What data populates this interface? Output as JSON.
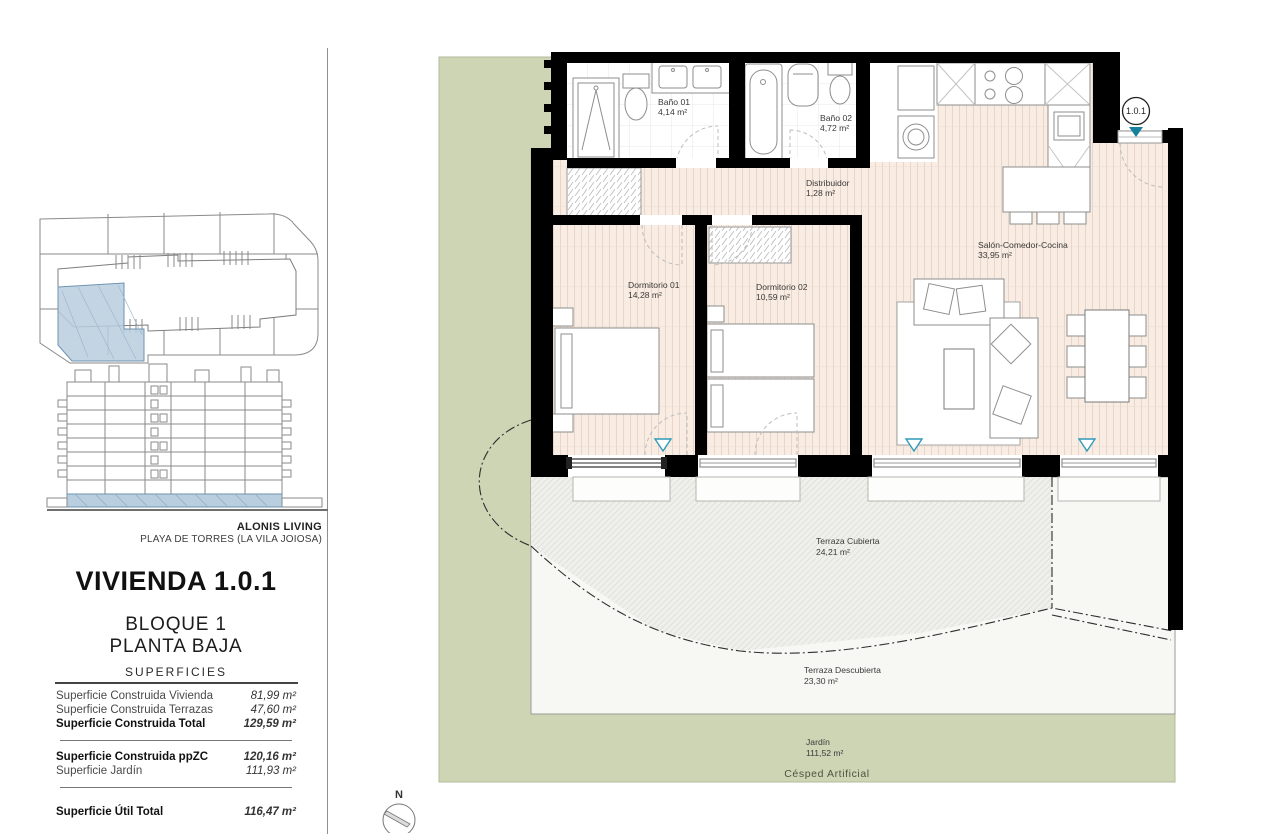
{
  "sidebar": {
    "brand": "ALONIS LIVING",
    "brand_sub": "PLAYA DE TORRES (LA VILA JOIOSA)",
    "title": "VIVIENDA 1.0.1",
    "block": "BLOQUE 1",
    "floor": "PLANTA BAJA",
    "table_title": "SUPERFICIES",
    "rows": [
      {
        "label": "Superficie Construida Vivienda",
        "value": "81,99 m²"
      },
      {
        "label": "Superficie Construida Terrazas",
        "value": "47,60 m²"
      },
      {
        "label": "Superficie Construida Total",
        "value": "129,59 m²"
      },
      {
        "label": "Superficie Construida ppZC",
        "value": "120,16 m²"
      },
      {
        "label": "Superficie Jardín",
        "value": "111,93 m²"
      },
      {
        "label": "Superficie Útil Total",
        "value": "116,47 m²"
      }
    ]
  },
  "plan": {
    "unit_tag": "1.0.1",
    "north_label": "N",
    "garden_label": "Césped Artificial",
    "rooms": [
      {
        "name": "Baño 01",
        "area": "4,14 m²"
      },
      {
        "name": "Baño 02",
        "area": "4,72 m²"
      },
      {
        "name": "Distribuidor",
        "area": "1,28 m²"
      },
      {
        "name": "Salón-Comedor-Cocina",
        "area": "33,95 m²"
      },
      {
        "name": "Dormitorio 01",
        "area": "14,28 m²"
      },
      {
        "name": "Dormitorio 02",
        "area": "10,59 m²"
      },
      {
        "name": "Terraza Cubierta",
        "area": "24,21 m²"
      },
      {
        "name": "Terraza Descubierta",
        "area": "23,30 m²"
      },
      {
        "name": "Jardín",
        "area": "111,52 m²"
      }
    ]
  },
  "colors": {
    "garden_green": "#cdd5b5",
    "wood_floor": "#f8ece3",
    "terrace_grey": "#f2f2ee",
    "wall_black": "#000000",
    "marker_teal": "#1b84a4",
    "keyplan_blue": "#b9cede"
  }
}
